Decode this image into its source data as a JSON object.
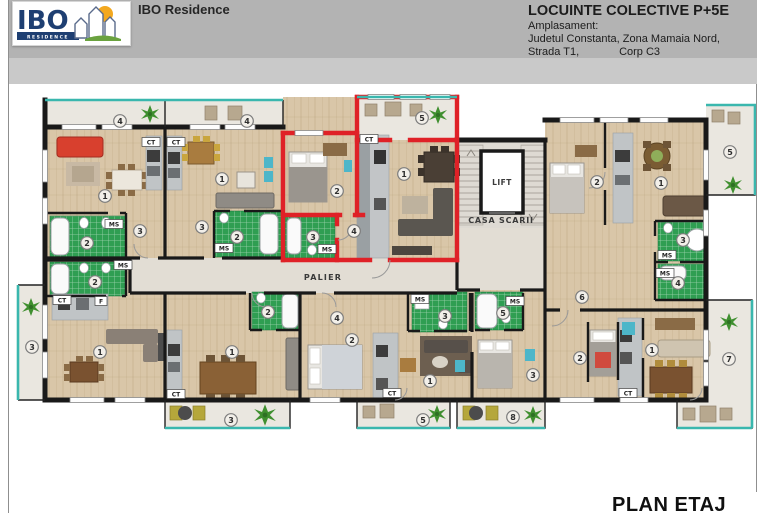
{
  "header": {
    "logo_main": "IBO",
    "logo_sub": "RESIDENCE",
    "brand": "IBO Residence",
    "title": "LOCUINTE COLECTIVE P+5E",
    "address_label": "Amplasament:",
    "address_line1": "Judetul Constanta, Zona Mamaia Nord,",
    "street": "Strada T1,",
    "corp": "Corp C3"
  },
  "plan": {
    "label": "PLAN ETAJ",
    "core": {
      "lift": "LIFT",
      "stairs": "CASA SCARII",
      "landing": "PALIER"
    },
    "room_markers": [
      {
        "n": "4",
        "x": 120,
        "y": 121
      },
      {
        "n": "4",
        "x": 247,
        "y": 121
      },
      {
        "n": "5",
        "x": 422,
        "y": 118
      },
      {
        "n": "1",
        "x": 105,
        "y": 196
      },
      {
        "n": "3",
        "x": 140,
        "y": 231
      },
      {
        "n": "2",
        "x": 87,
        "y": 243
      },
      {
        "n": "1",
        "x": 222,
        "y": 179
      },
      {
        "n": "3",
        "x": 202,
        "y": 227
      },
      {
        "n": "2",
        "x": 237,
        "y": 237
      },
      {
        "n": "2",
        "x": 337,
        "y": 191
      },
      {
        "n": "1",
        "x": 404,
        "y": 174
      },
      {
        "n": "4",
        "x": 354,
        "y": 231
      },
      {
        "n": "3",
        "x": 313,
        "y": 237
      },
      {
        "n": "2",
        "x": 597,
        "y": 182
      },
      {
        "n": "1",
        "x": 661,
        "y": 183
      },
      {
        "n": "5",
        "x": 730,
        "y": 152
      },
      {
        "n": "3",
        "x": 683,
        "y": 240
      },
      {
        "n": "4",
        "x": 678,
        "y": 283
      },
      {
        "n": "6",
        "x": 582,
        "y": 297
      },
      {
        "n": "2",
        "x": 95,
        "y": 282
      },
      {
        "n": "3",
        "x": 32,
        "y": 347
      },
      {
        "n": "1",
        "x": 100,
        "y": 352
      },
      {
        "n": "1",
        "x": 232,
        "y": 352
      },
      {
        "n": "2",
        "x": 268,
        "y": 312
      },
      {
        "n": "4",
        "x": 337,
        "y": 318
      },
      {
        "n": "2",
        "x": 352,
        "y": 340
      },
      {
        "n": "3",
        "x": 445,
        "y": 316
      },
      {
        "n": "1",
        "x": 430,
        "y": 381
      },
      {
        "n": "5",
        "x": 503,
        "y": 313
      },
      {
        "n": "3",
        "x": 533,
        "y": 375
      },
      {
        "n": "2",
        "x": 580,
        "y": 358
      },
      {
        "n": "1",
        "x": 652,
        "y": 350
      },
      {
        "n": "7",
        "x": 729,
        "y": 359
      },
      {
        "n": "3",
        "x": 231,
        "y": 420
      },
      {
        "n": "5",
        "x": 423,
        "y": 420
      },
      {
        "n": "8",
        "x": 513,
        "y": 417
      }
    ],
    "tag_markers": [
      {
        "t": "CT",
        "x": 151,
        "y": 142
      },
      {
        "t": "CT",
        "x": 176,
        "y": 142
      },
      {
        "t": "CT",
        "x": 369,
        "y": 139
      },
      {
        "t": "CT",
        "x": 62,
        "y": 300
      },
      {
        "t": "F",
        "x": 101,
        "y": 301
      },
      {
        "t": "CT",
        "x": 176,
        "y": 394
      },
      {
        "t": "CT",
        "x": 392,
        "y": 393
      },
      {
        "t": "CT",
        "x": 628,
        "y": 393
      },
      {
        "t": "MS",
        "x": 114,
        "y": 224
      },
      {
        "t": "MS",
        "x": 123,
        "y": 265
      },
      {
        "t": "MS",
        "x": 224,
        "y": 248
      },
      {
        "t": "MS",
        "x": 327,
        "y": 249
      },
      {
        "t": "MS",
        "x": 420,
        "y": 299
      },
      {
        "t": "MS",
        "x": 515,
        "y": 301
      },
      {
        "t": "MS",
        "x": 667,
        "y": 255
      },
      {
        "t": "MS",
        "x": 665,
        "y": 273
      }
    ],
    "text_labels": [
      {
        "t": "LIFT",
        "x": 502,
        "y": 185,
        "s": 7.5,
        "ls": 0.5
      },
      {
        "t": "CASA SCARII",
        "x": 501,
        "y": 223,
        "s": 8,
        "ls": 0.8
      },
      {
        "t": "PALIER",
        "x": 323,
        "y": 280,
        "s": 8,
        "ls": 1.2
      }
    ]
  },
  "colors": {
    "highlight_red": "#df2127",
    "balcony_teal": "#3ab7ae",
    "bath_green": "#2f9e52",
    "wood_floor": "#d9c6a8",
    "wall_black": "#191919",
    "header_gray": "#b3b3b3",
    "logo_navy": "#1e3f72",
    "sun_orange": "#f3a81f"
  }
}
